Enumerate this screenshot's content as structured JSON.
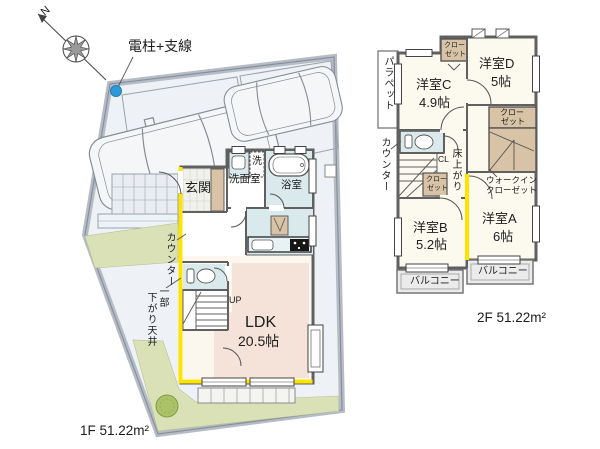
{
  "compass": {
    "north": "N"
  },
  "site": {
    "pole_label": "電柱+支線"
  },
  "floor1": {
    "genkan": "玄関",
    "washer": "洗",
    "washroom": "洗面室",
    "bath": "浴室",
    "counter": "カウンター",
    "ceiling_note_1": "一部",
    "ceiling_note_2": "下がり天井",
    "stairs_up": "UP",
    "ldk": "LDK",
    "ldk_size": "20.5帖",
    "area": "1F 51.22m²"
  },
  "floor2": {
    "parapet": "パラペット",
    "room_c": "洋室C",
    "room_c_size": "4.9帖",
    "room_d": "洋室D",
    "room_d_size": "5帖",
    "room_b": "洋室B",
    "room_b_size": "5.2帖",
    "room_a": "洋室A",
    "room_a_size": "6帖",
    "closet_line1": "クロー",
    "closet_line2": "ゼット",
    "wic_line1": "ウォークイン",
    "wic_line2": "クローゼット",
    "counter": "カウンター",
    "cl": "CL",
    "floor_step": "床上がり",
    "balcony_left": "バルコニー",
    "balcony_right": "バルコニー",
    "area": "2F 51.22m²"
  },
  "colors": {
    "accent_wall_yellow": "#ffe400",
    "closet_tan": "#d8c3a6",
    "water_area_blue": "#d9e9ec",
    "ldk_pink": "#f5e2d9",
    "lawn_green": "#dbe1b6",
    "driveway_gray": "#eef1f6",
    "wall_gray": "#606060",
    "pole_dot_blue": "#2e9bd6"
  }
}
